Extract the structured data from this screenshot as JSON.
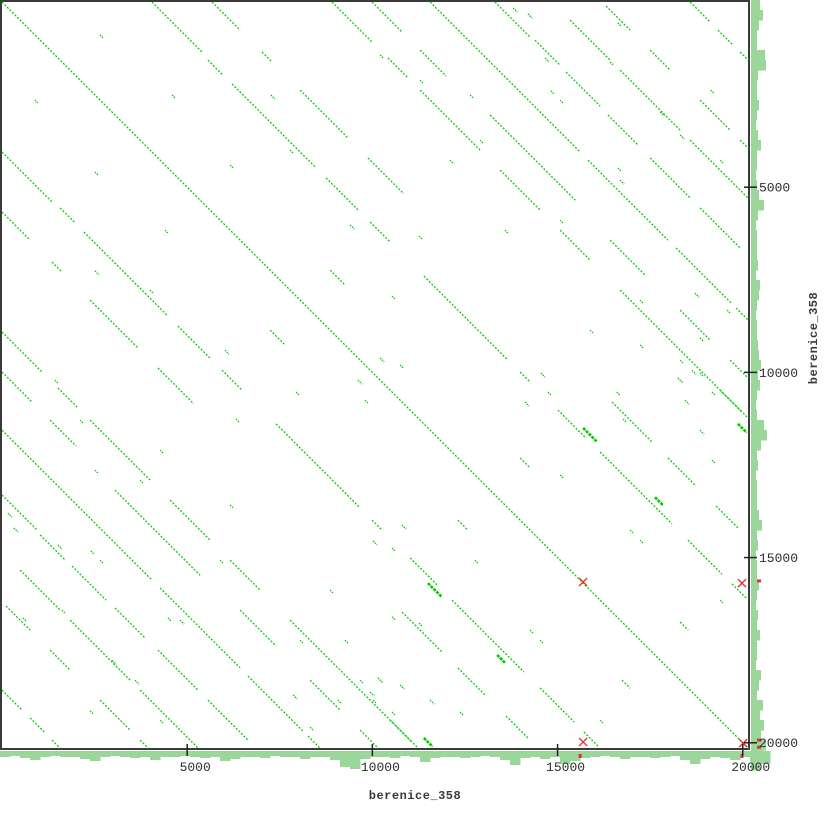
{
  "chart_data": {
    "type": "scatter",
    "subtype": "dotplot-self-alignment",
    "title": "",
    "x_sequence": "berenice_358",
    "y_sequence": "berenice_358",
    "axis": {
      "range_bp": [
        0,
        20160
      ],
      "ticks_bp": [
        5000,
        10000,
        15000,
        20000
      ],
      "tick_labels": [
        "5000",
        "10000",
        "15000",
        "20000"
      ],
      "grid": false,
      "tick_sides": [
        "bottom",
        "right"
      ]
    },
    "colors": {
      "match_line": "#00cc00",
      "profile_fill": "#9bd69b",
      "frame": "#3a3a3a",
      "tick_text": "#2e2e2e",
      "marker_red": "#dd3333",
      "plot_background": "#ffffff"
    },
    "diagonal_segments_bp": [
      [
        0,
        0,
        20160
      ],
      [
        4050,
        0,
        1350
      ],
      [
        5560,
        1570,
        380
      ],
      [
        6210,
        2210,
        2270
      ],
      [
        8750,
        4750,
        860
      ],
      [
        9940,
        5940,
        540
      ],
      [
        11390,
        7400,
        2270
      ],
      [
        13990,
        9990,
        270
      ],
      [
        15010,
        11020,
        760
      ],
      [
        16150,
        12150,
        1940
      ],
      [
        18520,
        14530,
        920
      ],
      [
        19710,
        15710,
        380
      ],
      [
        5670,
        0,
        760
      ],
      [
        7020,
        1350,
        270
      ],
      [
        8050,
        2380,
        1300
      ],
      [
        9880,
        4210,
        970
      ],
      [
        16470,
        10800,
        1080
      ],
      [
        17980,
        12310,
        760
      ],
      [
        19280,
        13610,
        590
      ],
      [
        8910,
        0,
        1080
      ],
      [
        10420,
        1510,
        540
      ],
      [
        11290,
        2380,
        1620
      ],
      [
        13450,
        4540,
        1080
      ],
      [
        15070,
        6160,
        810
      ],
      [
        16690,
        7780,
        1080
      ],
      [
        17790,
        8880,
        2160
      ],
      [
        19390,
        10480,
        760
      ],
      [
        9990,
        0,
        810
      ],
      [
        11290,
        1300,
        700
      ],
      [
        13180,
        3050,
        2300
      ],
      [
        16420,
        6430,
        970
      ],
      [
        18310,
        8320,
        810
      ],
      [
        19660,
        9670,
        490
      ],
      [
        11560,
        0,
        4050
      ],
      [
        15820,
        4270,
        2160
      ],
      [
        18200,
        6640,
        1510
      ],
      [
        19820,
        8260,
        320
      ],
      [
        13310,
        0,
        950
      ],
      [
        14390,
        1030,
        680
      ],
      [
        15230,
        1890,
        920
      ],
      [
        16360,
        3050,
        810
      ],
      [
        17500,
        4210,
        1080
      ],
      [
        18850,
        5560,
        1080
      ],
      [
        15340,
        490,
        1080
      ],
      [
        16690,
        1840,
        1620
      ],
      [
        18580,
        3730,
        1570
      ],
      [
        16310,
        110,
        650
      ],
      [
        17500,
        1300,
        540
      ],
      [
        18850,
        2650,
        810
      ],
      [
        19930,
        3730,
        220
      ],
      [
        18580,
        0,
        540
      ],
      [
        19330,
        760,
        380
      ],
      [
        19930,
        1350,
        220
      ],
      [
        8860,
        7240,
        380
      ],
      [
        13990,
        12310,
        270
      ],
      [
        18310,
        16740,
        220
      ]
    ],
    "specks_bp": [
      [
        2650,
        890,
        80
      ],
      [
        4590,
        2510,
        80
      ],
      [
        7260,
        2510,
        110
      ],
      [
        10210,
        1430,
        80
      ],
      [
        14660,
        1510,
        110
      ],
      [
        16420,
        1620,
        80
      ],
      [
        17770,
        2970,
        110
      ],
      [
        10210,
        9610,
        110
      ],
      [
        9800,
        10750,
        80
      ],
      [
        7940,
        10530,
        80
      ],
      [
        14550,
        10020,
        110
      ],
      [
        14740,
        10530,
        80
      ],
      [
        14120,
        10800,
        110
      ],
      [
        16770,
        11260,
        80
      ],
      [
        6320,
        11260,
        80
      ],
      [
        18850,
        10020,
        80
      ],
      [
        19170,
        10530,
        80
      ],
      [
        18440,
        10750,
        110
      ],
      [
        4400,
        6160,
        80
      ],
      [
        12100,
        4270,
        80
      ],
      [
        13580,
        6160,
        80
      ],
      [
        7780,
        4000,
        80
      ],
      [
        9400,
        6020,
        110
      ],
      [
        15880,
        8860,
        80
      ],
      [
        17230,
        9260,
        80
      ],
      [
        12640,
        2510,
        80
      ],
      [
        19390,
        4270,
        80
      ],
      [
        18310,
        3590,
        110
      ],
      [
        15070,
        12770,
        80
      ],
      [
        16960,
        14260,
        80
      ],
      [
        19390,
        16150,
        80
      ],
      [
        14530,
        17230,
        80
      ],
      [
        9670,
        18310,
        80
      ],
      [
        11560,
        18850,
        110
      ],
      [
        5890,
        15070,
        80
      ],
      [
        3730,
        12910,
        80
      ],
      [
        2110,
        11290,
        80
      ],
      [
        8050,
        17230,
        80
      ],
      [
        4810,
        16690,
        110
      ],
      [
        2650,
        15070,
        80
      ],
      [
        10150,
        18250,
        130
      ],
      [
        9940,
        18630,
        110
      ],
      [
        9070,
        18850,
        80
      ],
      [
        12370,
        19170,
        80
      ],
      [
        10530,
        16600,
        80
      ],
      [
        7860,
        18710,
        110
      ],
      [
        8320,
        19580,
        80
      ],
      [
        14820,
        2400,
        80
      ],
      [
        16630,
        4480,
        80
      ],
      [
        19140,
        2380,
        80
      ],
      [
        16630,
        570,
        80
      ],
      [
        13800,
        160,
        110
      ],
      [
        14200,
        320,
        110
      ]
    ],
    "bold_segments_bp": [
      [
        11500,
        15690,
        380
      ],
      [
        11390,
        19870,
        240
      ],
      [
        13370,
        17630,
        220
      ]
    ],
    "red_crosses_bp": [
      [
        15690,
        15660
      ],
      [
        19980,
        15690
      ],
      [
        15690,
        19980
      ],
      [
        20010,
        20010
      ]
    ],
    "red_dots_right_bp": [
      15630,
      19930,
      20120
    ],
    "red_dots_bottom_bp": [
      15610,
      19980
    ],
    "profile_bottom_px": [
      6,
      5,
      7,
      9,
      6,
      5,
      6,
      6,
      8,
      10,
      6,
      5,
      6,
      7,
      6,
      9,
      6,
      6,
      5,
      6,
      7,
      6,
      10,
      8,
      6,
      6,
      7,
      5,
      6,
      6,
      8,
      6,
      6,
      9,
      16,
      18,
      8,
      6,
      6,
      7,
      5,
      6,
      11,
      7,
      6,
      6,
      7,
      6,
      5,
      6,
      9,
      14,
      7,
      6,
      8,
      6,
      13,
      10,
      7,
      6,
      5,
      6,
      8,
      6,
      6,
      7,
      6,
      5,
      9,
      13,
      8,
      6,
      7,
      9,
      6,
      11,
      13
    ],
    "profile_right_px": [
      9,
      12,
      8,
      6,
      6,
      14,
      15,
      7,
      6,
      6,
      8,
      6,
      5,
      7,
      10,
      6,
      6,
      5,
      6,
      8,
      13,
      7,
      5,
      6,
      6,
      6,
      7,
      5,
      9,
      8,
      6,
      5,
      6,
      6,
      7,
      8,
      10,
      7,
      9,
      6,
      5,
      6,
      13,
      16,
      10,
      6,
      7,
      5,
      6,
      6,
      6,
      8,
      11,
      6,
      7,
      5,
      6,
      6,
      8,
      6,
      5,
      7,
      6,
      9,
      6,
      6,
      5,
      10,
      8,
      6,
      12,
      9,
      13,
      10,
      15,
      12,
      9
    ]
  }
}
